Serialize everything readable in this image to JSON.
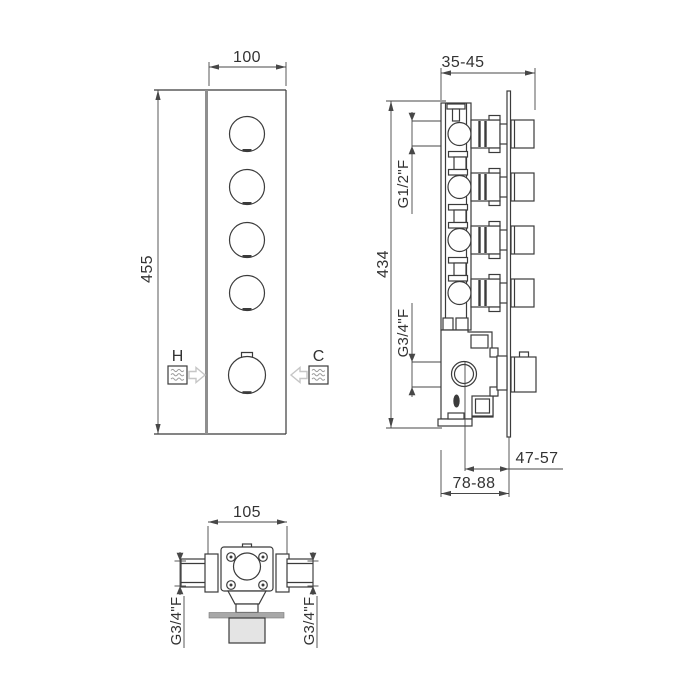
{
  "views": {
    "front": {
      "width_dim": "100",
      "height_dim": "455",
      "hot_label": "H",
      "cold_label": "C"
    },
    "side": {
      "depth_dim": "35-45",
      "height_dim": "434",
      "upper_port_dim": "G1/2\"F",
      "lower_port_dim": "G3/4\"F",
      "center_to_wall_dim": "47-57",
      "body_to_wall_dim": "78-88"
    },
    "top": {
      "width_dim": "105",
      "left_port_dim": "G3/4\"F",
      "right_port_dim": "G3/4\"F"
    },
    "icons": {
      "hot_inlet": "water-square-icon",
      "hot_flow": "block-arrow-right-icon",
      "cold_inlet": "water-square-icon",
      "cold_flow": "block-arrow-left-icon"
    }
  },
  "colors": {
    "line": "#3b3b3b",
    "dim": "#474747",
    "text": "#333333",
    "wall": "#8f8f8f",
    "arrow_gray": "#c6c6c6",
    "plate_fill": "#a8a8a8",
    "knob_fill": "#e4e4e4",
    "background": "#ffffff"
  }
}
